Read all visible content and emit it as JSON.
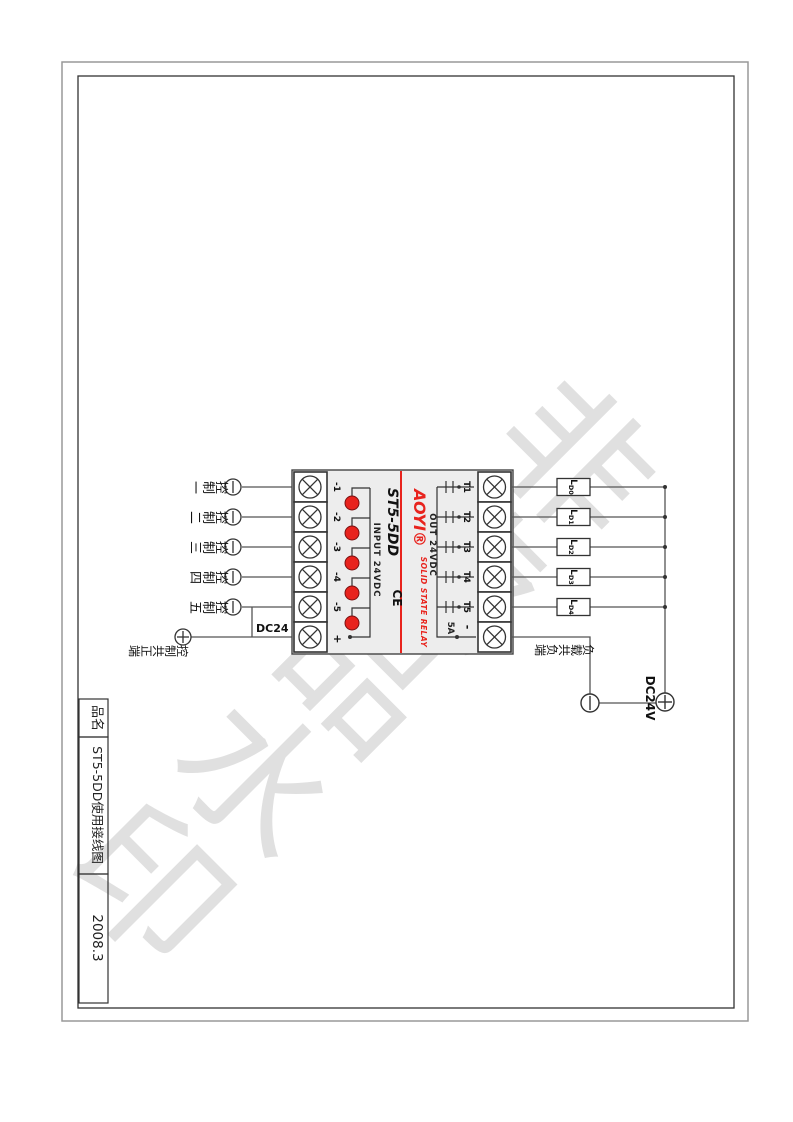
{
  "document": {
    "watermark": "非卖品水印"
  },
  "title_block": {
    "label": "品名",
    "title": "ST5-5DD使用接线图",
    "date": "2008.3"
  },
  "relay": {
    "model": "ST5-5DD",
    "brand": "AOYI®",
    "subtitle": "SOLID STATE RELAY",
    "ce": "CE",
    "input_label": "INPUT 24VDC",
    "output_label": "OUT 24VDC",
    "rating": "5A",
    "input_terminals": [
      "-1",
      "-2",
      "-3",
      "-4",
      "-5",
      "+"
    ],
    "output_terminals": [
      "T1",
      "T2",
      "T3",
      "T4",
      "T5",
      "-"
    ]
  },
  "left": {
    "controls": [
      "控制一",
      "控制二",
      "控制三",
      "控制四",
      "控制五"
    ],
    "common": "控制共正端",
    "voltage": "DC24 V"
  },
  "right": {
    "loads": [
      {
        "p": "L",
        "s": "D0"
      },
      {
        "p": "L",
        "s": "D1"
      },
      {
        "p": "L",
        "s": "D2"
      },
      {
        "p": "L",
        "s": "D3"
      },
      {
        "p": "L",
        "s": "D4"
      }
    ],
    "common": "负载共负端",
    "voltage": "DC24V"
  },
  "colors": {
    "red": "#e8231d",
    "body_gray": "#ededed",
    "wire": "#555555",
    "frame_outer": "#999999",
    "frame_inner": "#333333",
    "watermark": "#c2c2c2"
  }
}
